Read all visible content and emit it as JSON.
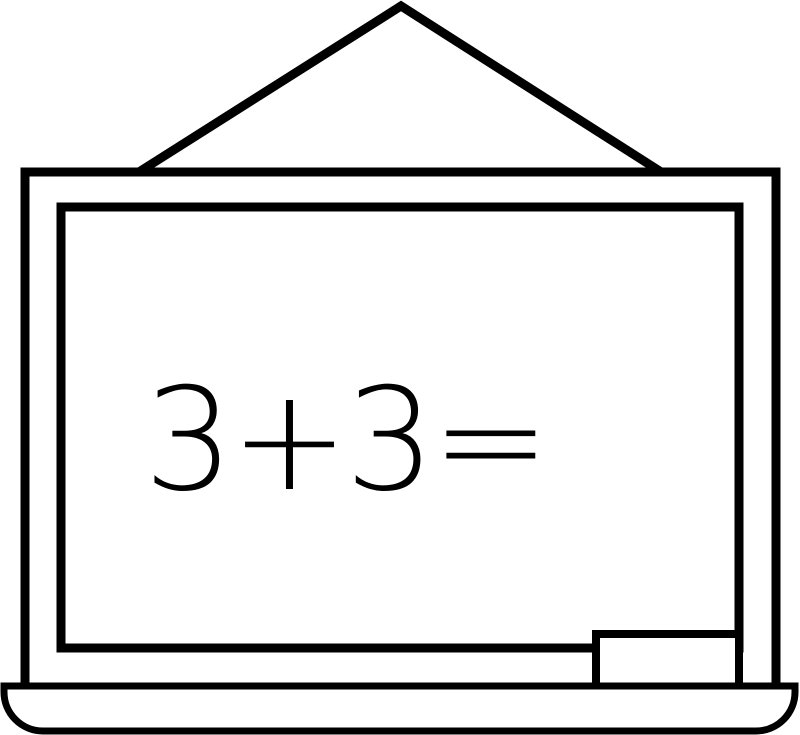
{
  "board": {
    "equation": "3+3="
  },
  "colors": {
    "line": "#000000",
    "surface": "#ffffff"
  }
}
